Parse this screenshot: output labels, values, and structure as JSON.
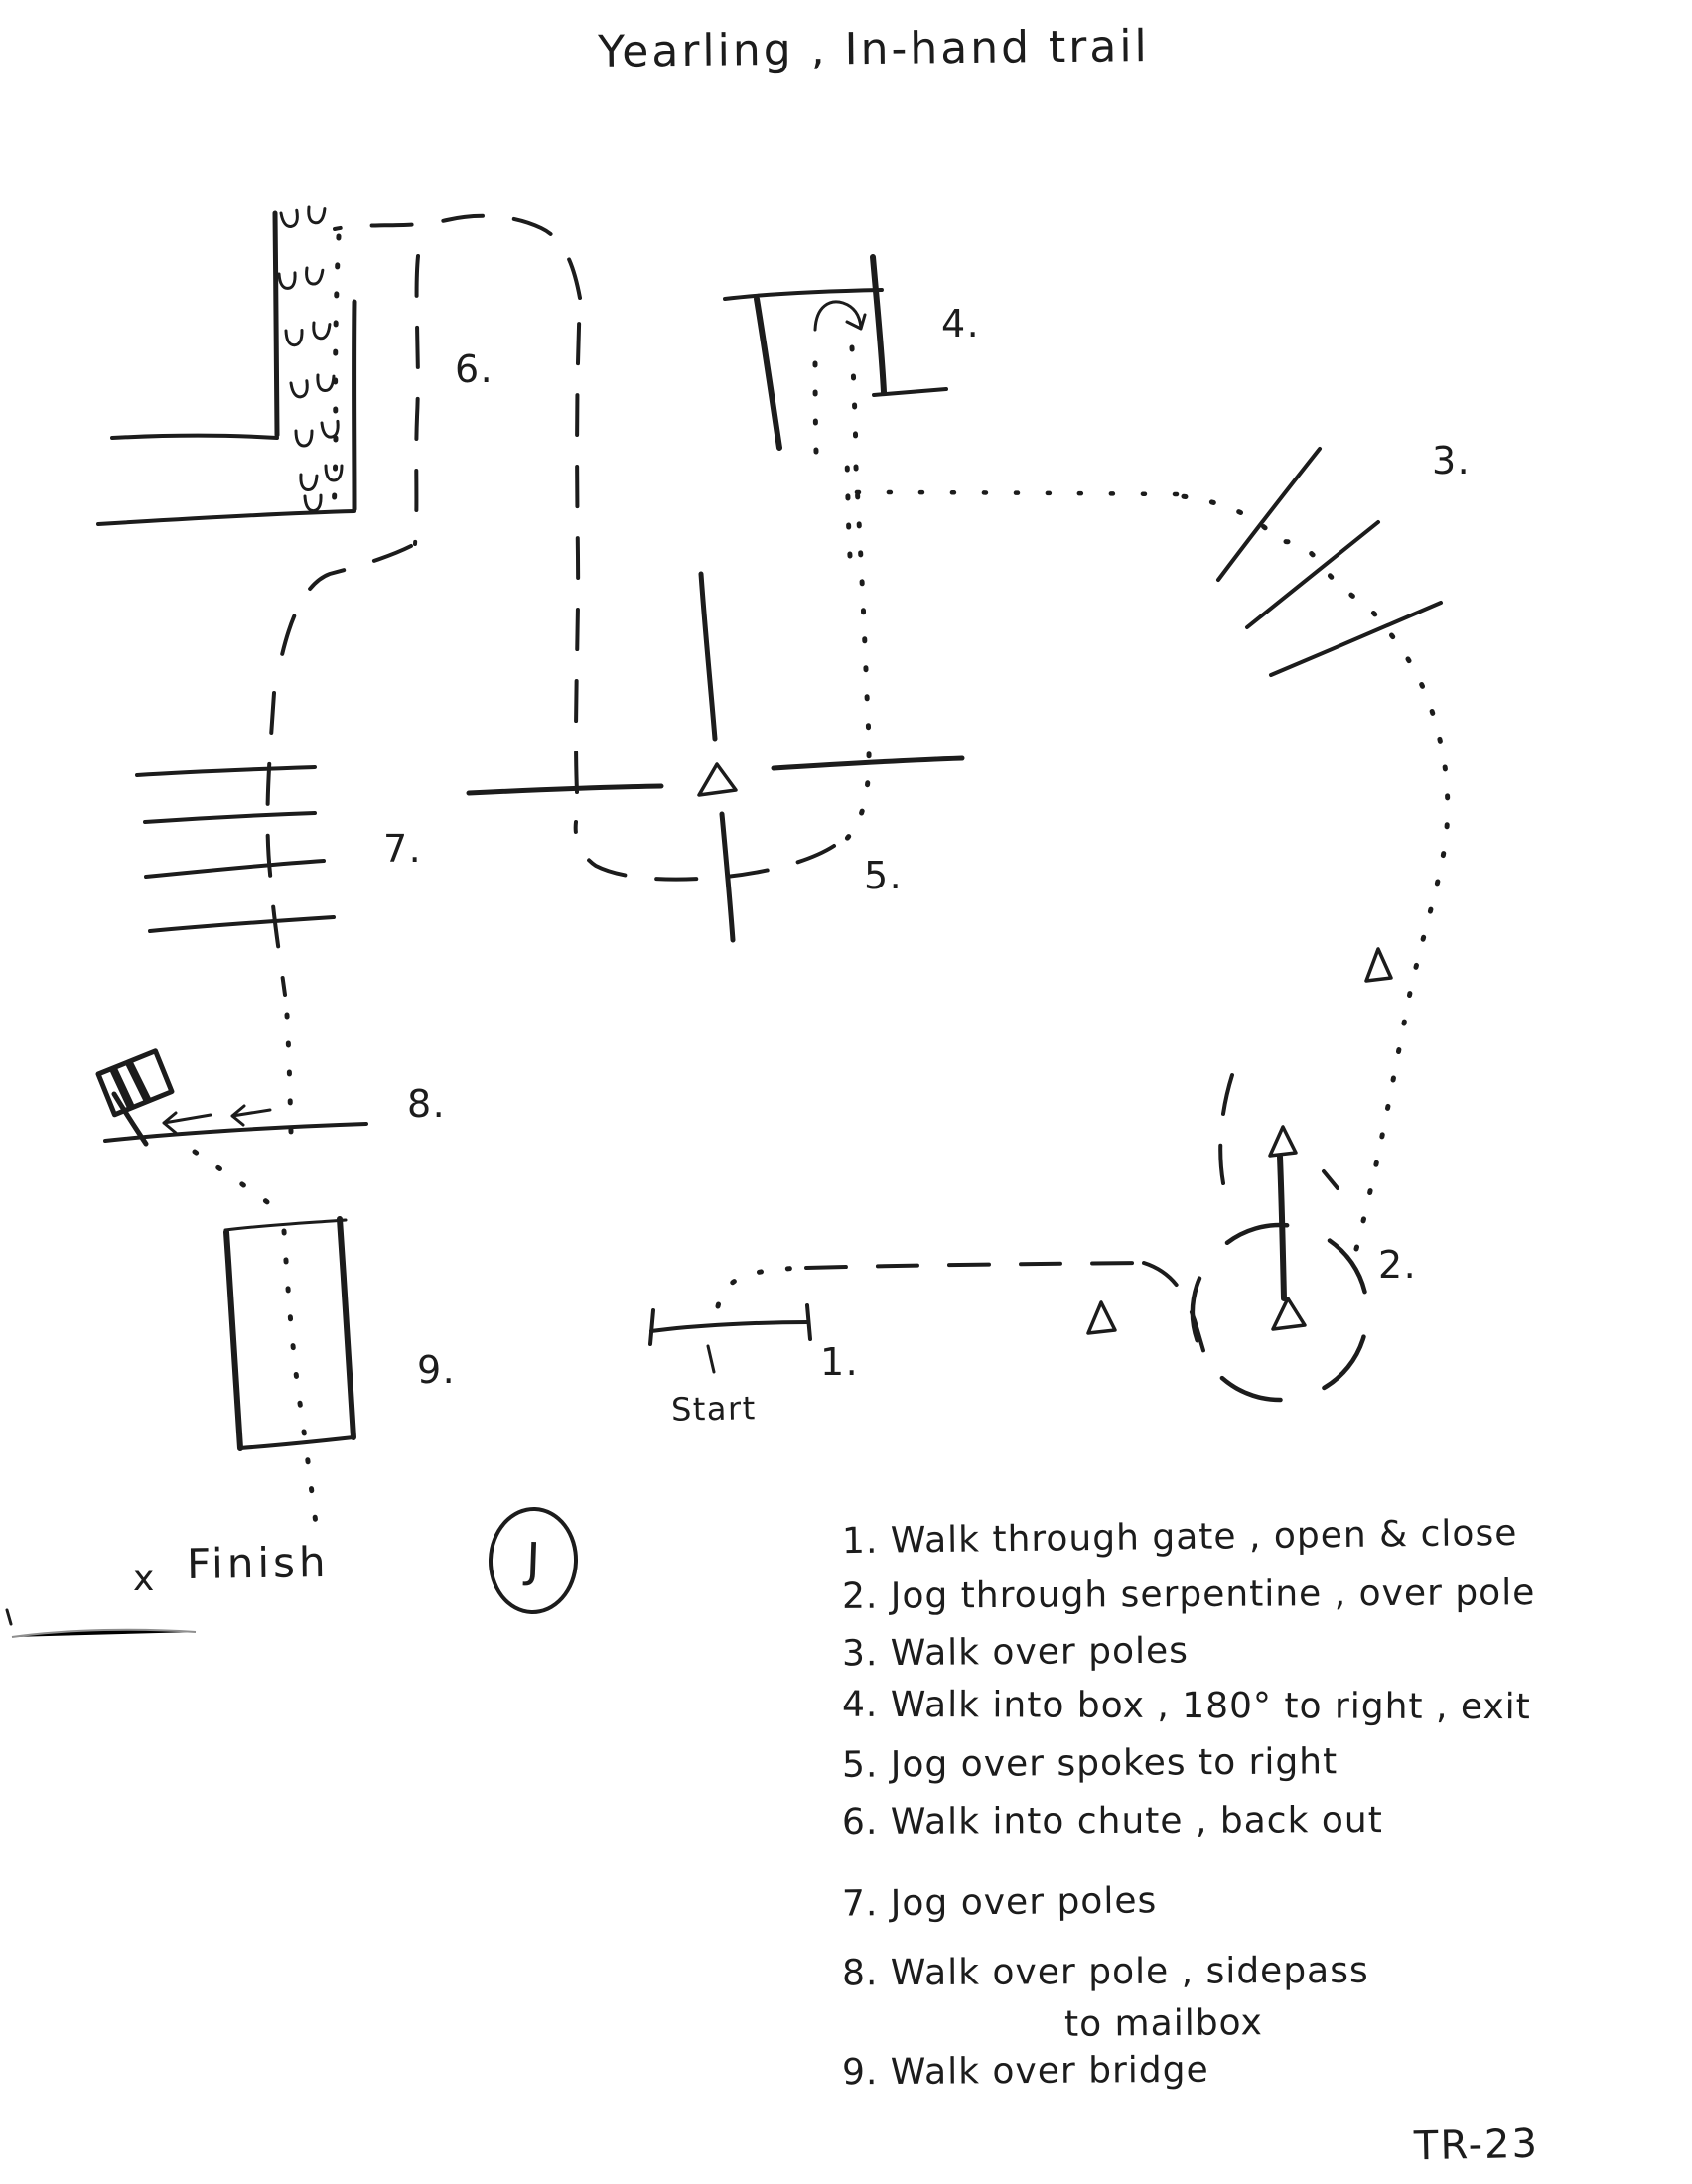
{
  "page": {
    "title": "Yearling , In-hand trail",
    "course_code": "TR-23",
    "ink_color": "#1c1c1c",
    "paper_color": "#ffffff"
  },
  "map": {
    "start_label": "Start",
    "finish_x": "x",
    "finish_label": "Finish",
    "judge_label": "J",
    "obstacle_labels": [
      "1.",
      "2.",
      "3.",
      "4.",
      "5.",
      "6.",
      "7.",
      "8.",
      "9."
    ],
    "icons": {
      "cone": "triangle-cone-icon",
      "hoofprint": "u-hoofprint-icon",
      "mailbox": "mailbox-icon",
      "sidepass_arrows": "left-arrows-icon",
      "turn_arrow": "180-degree-turn-arrow-icon"
    }
  },
  "legend": {
    "lines": [
      "1. Walk through gate , open & close",
      "2. Jog through serpentine , over pole",
      "3. Walk over poles",
      "4. Walk into box , 180° to right , exit",
      "5. Jog over spokes to right",
      "6. Walk into chute , back out",
      "7. Jog over poles",
      "8. Walk over pole , sidepass",
      "to mailbox",
      "9. Walk over bridge"
    ]
  }
}
